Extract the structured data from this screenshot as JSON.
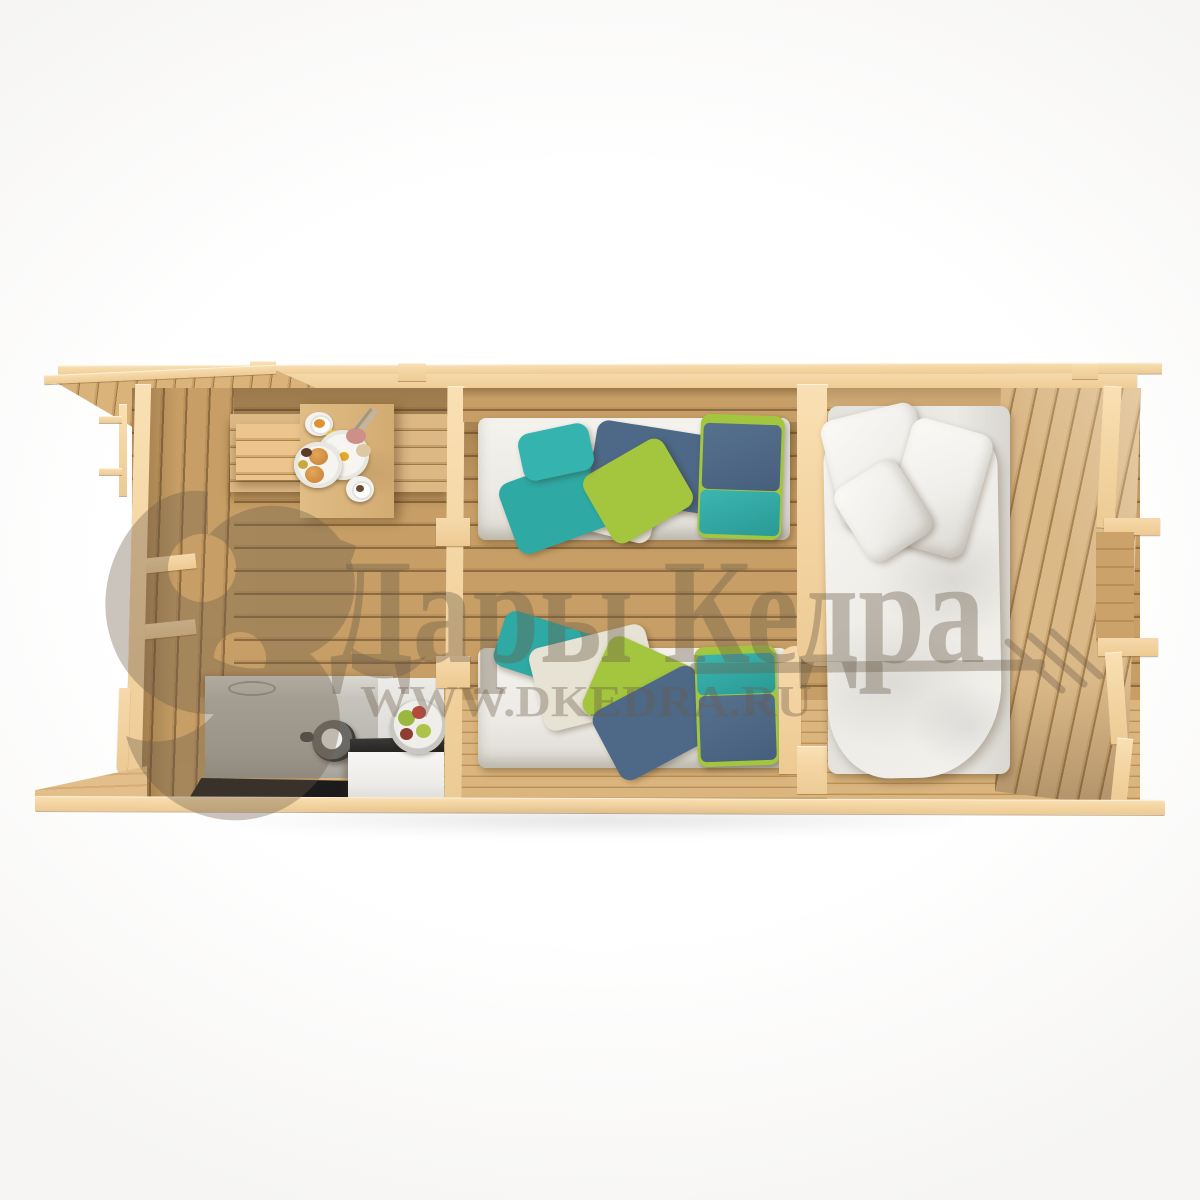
{
  "image_type": "3d-top-down-cutaway-render-of-log-cabin",
  "watermark": {
    "brand": "Дары Кедра",
    "url": "WWW.DKEDRA.RU",
    "logo": "squirrel-silhouette",
    "color": "#6b5c49"
  },
  "scene": {
    "rooms": [
      {
        "name": "kitchen-dining-room",
        "furniture": [
          "corner-bench",
          "breakfast-table",
          "kitchen-counter",
          "kettle",
          "induction-hob",
          "white-cabinet",
          "fruit-bowl"
        ]
      },
      {
        "name": "twin-bedroom",
        "furniture": [
          "single-bed-top",
          "single-bed-bottom"
        ]
      },
      {
        "name": "master-bedroom",
        "furniture": [
          "double-bed"
        ]
      }
    ],
    "colors": {
      "wood_cut": "#f3d4a2",
      "wood_wall": "#c49a62",
      "wood_floor": "#d9b47c",
      "bedding_white": "#f1f0ec",
      "blanket_teal": "#2fa9a4",
      "blanket_green": "#a4c53e",
      "blanket_blue": "#4d6987",
      "counter_gray": "#c0beb6",
      "hob_black": "#1b1b1b"
    }
  }
}
